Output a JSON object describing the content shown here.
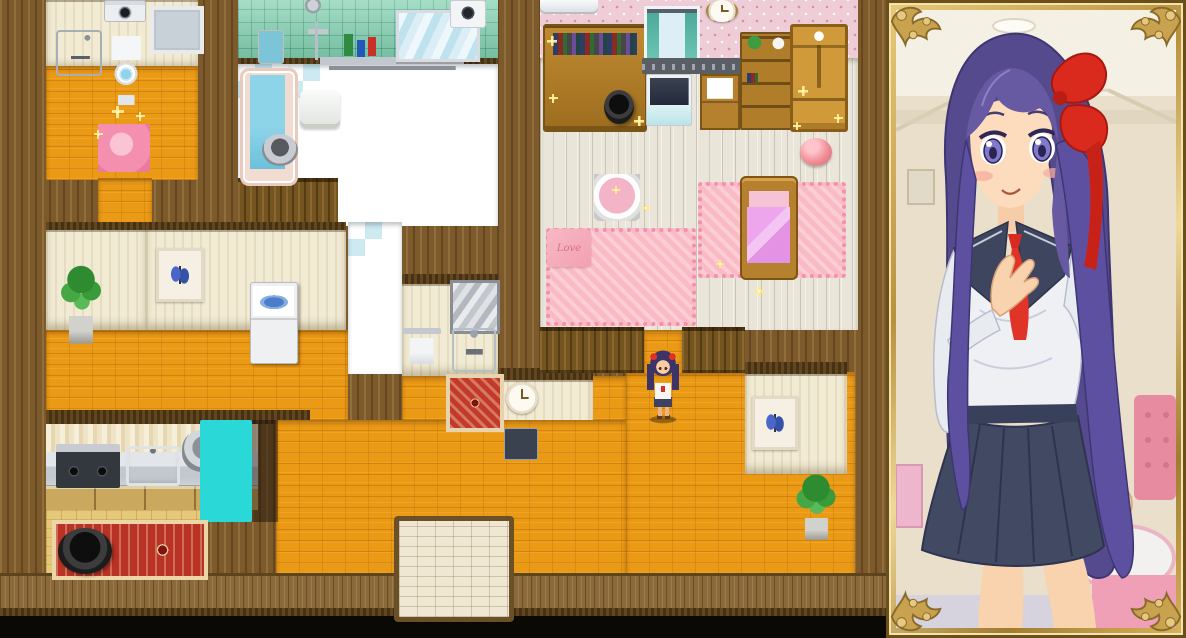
{
  "scene": {
    "view": "top-down-house-map-with-character-portrait",
    "texts": {
      "love_pillow": "Love"
    }
  },
  "palette": {
    "floor_orange": "#eb9a16",
    "wall_wood": "#7c5a2b",
    "wall_cream": "#f2ebd4",
    "tile_green": "#84d0b2",
    "checker_blue": "#cde9f2",
    "wallpaper_pink": "#eecdd6",
    "plank_floor": "#e9e6d9",
    "rug_pink": "#f9bac4",
    "bed_blanket_purple": "#e493e4",
    "kitchen_floor": "#e6c879",
    "rug_red": "#b93325",
    "frame_gold": "#c9a24f",
    "hair_purple": "#564a8e",
    "bow_red": "#da2a1e",
    "uniform_navy": "#3e455e",
    "skin": "#fbd9ba"
  },
  "map": {
    "regions": [
      {
        "id": "outer-wall-backdrop",
        "cls": "r-wall-wood",
        "x": 0,
        "y": 0,
        "w": 890,
        "h": 638,
        "i": false
      },
      {
        "id": "toilet-room-wall",
        "cls": "r-wall-cream",
        "x": 46,
        "y": 0,
        "w": 152,
        "h": 70,
        "i": false
      },
      {
        "id": "toilet-room-floor",
        "cls": "r-floor-orange",
        "x": 46,
        "y": 66,
        "w": 152,
        "h": 114,
        "i": false
      },
      {
        "id": "hall-corridor-north",
        "cls": "r-floor-orange",
        "x": 98,
        "y": 178,
        "w": 54,
        "h": 156,
        "i": false
      },
      {
        "id": "bathroom-tile-wall",
        "cls": "r-wall-tile-green",
        "x": 238,
        "y": 0,
        "w": 260,
        "h": 62,
        "i": false
      },
      {
        "id": "bathroom-wall-cap",
        "cls": "r-cap",
        "x": 238,
        "y": 58,
        "w": 260,
        "h": 8,
        "i": false
      },
      {
        "id": "bathroom-floor",
        "cls": "r-floor-checker",
        "x": 286,
        "y": 64,
        "w": 212,
        "h": 162,
        "i": false
      },
      {
        "id": "bathroom-tub-bay",
        "cls": "r-floor-checker",
        "x": 238,
        "y": 64,
        "w": 52,
        "h": 116,
        "i": false
      },
      {
        "id": "tub-south-wall",
        "cls": "r-wall-wood-v",
        "x": 238,
        "y": 178,
        "w": 100,
        "h": 50,
        "i": false
      },
      {
        "id": "bath-corridor",
        "cls": "r-floor-checker",
        "x": 348,
        "y": 222,
        "w": 54,
        "h": 152,
        "i": false
      },
      {
        "id": "plant-niche-cap",
        "cls": "r-cap",
        "x": 46,
        "y": 222,
        "w": 100,
        "h": 10,
        "i": false
      },
      {
        "id": "plant-niche-wall",
        "cls": "r-wall-cream",
        "x": 46,
        "y": 230,
        "w": 100,
        "h": 100,
        "i": false
      },
      {
        "id": "hall-wall-cap",
        "cls": "r-cap",
        "x": 146,
        "y": 222,
        "w": 200,
        "h": 10,
        "i": false
      },
      {
        "id": "hall-wall",
        "cls": "r-wall-cream",
        "x": 146,
        "y": 230,
        "w": 200,
        "h": 100,
        "i": false
      },
      {
        "id": "hall-floor-west",
        "cls": "r-floor-orange",
        "x": 46,
        "y": 330,
        "w": 302,
        "h": 90,
        "i": false
      },
      {
        "id": "hall-floor-mid",
        "cls": "r-floor-orange",
        "x": 402,
        "y": 376,
        "w": 224,
        "h": 44,
        "i": false
      },
      {
        "id": "washroom-wall-cap",
        "cls": "r-cap",
        "x": 402,
        "y": 274,
        "w": 96,
        "h": 10,
        "i": false
      },
      {
        "id": "washroom-wall",
        "cls": "r-wall-cream",
        "x": 402,
        "y": 284,
        "w": 96,
        "h": 92,
        "i": false
      },
      {
        "id": "clock-wall-cap",
        "cls": "r-cap",
        "x": 498,
        "y": 368,
        "w": 95,
        "h": 12,
        "i": false
      },
      {
        "id": "clock-wall",
        "cls": "r-wall-cream",
        "x": 498,
        "y": 380,
        "w": 95,
        "h": 90,
        "i": false
      },
      {
        "id": "kitchen-wall-cap",
        "cls": "r-cap",
        "x": 46,
        "y": 410,
        "w": 264,
        "h": 14,
        "i": false
      },
      {
        "id": "kitchen-curtain",
        "cls": "r-curtain",
        "x": 46,
        "y": 424,
        "w": 212,
        "h": 32,
        "i": false
      },
      {
        "id": "kitchen-counter",
        "cls": "r-counter",
        "x": 46,
        "y": 452,
        "w": 212,
        "h": 36,
        "i": false
      },
      {
        "id": "kitchen-floor",
        "cls": "r-floor-kitchen",
        "x": 46,
        "y": 486,
        "w": 154,
        "h": 88,
        "i": false
      },
      {
        "id": "floor-south-center",
        "cls": "r-floor-orange",
        "x": 276,
        "y": 420,
        "w": 350,
        "h": 154,
        "i": false
      },
      {
        "id": "floor-south-east",
        "cls": "r-floor-orange",
        "x": 626,
        "y": 372,
        "w": 229,
        "h": 202,
        "i": false
      },
      {
        "id": "bedroom-wallpaper",
        "cls": "r-wall-pink",
        "x": 540,
        "y": 0,
        "w": 318,
        "h": 58,
        "i": false
      },
      {
        "id": "bedroom-floor",
        "cls": "r-floor-plank",
        "x": 540,
        "y": 58,
        "w": 318,
        "h": 272,
        "i": false
      },
      {
        "id": "bedroom-doorway-floor",
        "cls": "r-floor-orange",
        "x": 644,
        "y": 330,
        "w": 38,
        "h": 44,
        "i": true
      },
      {
        "id": "bedroom-south-wall-west",
        "cls": "r-wall-wood-v",
        "x": 540,
        "y": 327,
        "w": 104,
        "h": 46,
        "i": false
      },
      {
        "id": "bedroom-south-wall-east",
        "cls": "r-wall-wood-v",
        "x": 682,
        "y": 327,
        "w": 63,
        "h": 46,
        "i": false
      },
      {
        "id": "se-niche-cap",
        "cls": "r-cap",
        "x": 745,
        "y": 362,
        "w": 102,
        "h": 12,
        "i": false
      },
      {
        "id": "se-niche-wall",
        "cls": "r-wall-cream",
        "x": 745,
        "y": 374,
        "w": 102,
        "h": 100,
        "i": false
      },
      {
        "id": "south-wainscot",
        "cls": "r-wainscot",
        "x": 0,
        "y": 573,
        "w": 890,
        "h": 40,
        "i": false
      },
      {
        "id": "south-wall-trim",
        "cls": "r-cap",
        "x": 0,
        "y": 608,
        "w": 890,
        "h": 10,
        "i": false
      },
      {
        "id": "south-doorway-dark",
        "cls": "r-black",
        "x": 0,
        "y": 616,
        "w": 890,
        "h": 22,
        "i": false
      }
    ],
    "objects": [
      {
        "id": "washing-machine-small",
        "cls": "o-washer-front",
        "x": 104,
        "y": 0,
        "w": 40,
        "h": 20,
        "i": true
      },
      {
        "id": "toilet-window",
        "cls": "o-window",
        "x": 150,
        "y": 6,
        "w": 46,
        "h": 40,
        "i": false
      },
      {
        "id": "toilet-sink",
        "cls": "o-sink-wall",
        "x": 56,
        "y": 30,
        "w": 42,
        "h": 42,
        "i": true
      },
      {
        "id": "toilet",
        "cls": "o-toilet",
        "x": 108,
        "y": 34,
        "w": 36,
        "h": 72,
        "i": true
      },
      {
        "id": "toilet-rug",
        "cls": "o-rug-round-pink",
        "x": 98,
        "y": 124,
        "w": 52,
        "h": 48,
        "i": false
      },
      {
        "id": "shower-head",
        "cls": "o-shower",
        "x": 298,
        "y": 0,
        "w": 44,
        "h": 60,
        "i": true
      },
      {
        "id": "bath-control-panel",
        "cls": "o-panel-remote",
        "x": 258,
        "y": 30,
        "w": 24,
        "h": 32,
        "i": true
      },
      {
        "id": "shampoo-shelf",
        "cls": "o-shelf-bottles",
        "x": 320,
        "y": 30,
        "w": 144,
        "h": 40,
        "i": true
      },
      {
        "id": "bathroom-mirror",
        "cls": "o-mirror-wide",
        "x": 396,
        "y": 10,
        "w": 78,
        "h": 46,
        "i": false
      },
      {
        "id": "ventilation-fan",
        "cls": "o-fan",
        "x": 450,
        "y": 0,
        "w": 34,
        "h": 26,
        "i": false
      },
      {
        "id": "bathtub",
        "cls": "o-tub",
        "x": 240,
        "y": 68,
        "w": 52,
        "h": 112,
        "i": true
      },
      {
        "id": "bath-bucket",
        "cls": "o-bucket",
        "x": 262,
        "y": 134,
        "w": 36,
        "h": 32,
        "i": true
      },
      {
        "id": "bath-stool",
        "cls": "o-stool",
        "x": 300,
        "y": 90,
        "w": 40,
        "h": 38,
        "i": true
      },
      {
        "id": "potted-plant-hall",
        "cls": "o-plant",
        "x": 58,
        "y": 252,
        "w": 46,
        "h": 92,
        "i": true
      },
      {
        "id": "butterfly-picture-hall",
        "cls": "o-pic-butterfly",
        "x": 156,
        "y": 248,
        "w": 42,
        "h": 48,
        "i": false
      },
      {
        "id": "washing-machine-top-load",
        "cls": "o-washer-top",
        "x": 250,
        "y": 282,
        "w": 46,
        "h": 80,
        "i": true
      },
      {
        "id": "washroom-mirror",
        "cls": "o-mirror-grey",
        "x": 450,
        "y": 280,
        "w": 44,
        "h": 48,
        "i": false
      },
      {
        "id": "towel-rack",
        "cls": "o-towel-rack",
        "x": 403,
        "y": 328,
        "w": 38,
        "h": 36,
        "i": true
      },
      {
        "id": "washroom-sink",
        "cls": "o-sink-small",
        "x": 452,
        "y": 328,
        "w": 40,
        "h": 40,
        "i": true
      },
      {
        "id": "washroom-rug",
        "cls": "o-rug-red-sq",
        "x": 446,
        "y": 374,
        "w": 50,
        "h": 50,
        "i": false
      },
      {
        "id": "hall-clock",
        "cls": "o-clock",
        "x": 506,
        "y": 382,
        "w": 32,
        "h": 32,
        "i": false
      },
      {
        "id": "wall-phone",
        "cls": "o-phone",
        "x": 504,
        "y": 428,
        "w": 32,
        "h": 30,
        "i": true
      },
      {
        "id": "kitchen-counter-lower",
        "cls": "o-counter-lower",
        "x": 46,
        "y": 486,
        "w": 212,
        "h": 24,
        "i": false
      },
      {
        "id": "stove",
        "cls": "o-stove",
        "x": 56,
        "y": 444,
        "w": 64,
        "h": 44,
        "i": true
      },
      {
        "id": "kitchen-sink",
        "cls": "o-sink-kitchen",
        "x": 126,
        "y": 446,
        "w": 54,
        "h": 40,
        "i": true
      },
      {
        "id": "cooking-pot",
        "cls": "o-pot-steel",
        "x": 182,
        "y": 430,
        "w": 44,
        "h": 42,
        "i": true
      },
      {
        "id": "refrigerator",
        "cls": "o-fridge",
        "x": 200,
        "y": 420,
        "w": 52,
        "h": 102,
        "i": true
      },
      {
        "id": "fridge-shadow",
        "cls": "o-shadow",
        "x": 252,
        "y": 420,
        "w": 26,
        "h": 102,
        "i": false
      },
      {
        "id": "kitchen-rug",
        "cls": "o-rug-red-long",
        "x": 52,
        "y": 520,
        "w": 148,
        "h": 52,
        "i": false
      },
      {
        "id": "kitchen-pot-black",
        "cls": "o-pot-black",
        "x": 58,
        "y": 528,
        "w": 54,
        "h": 46,
        "i": true
      },
      {
        "id": "entry-mat",
        "cls": "o-door-mat",
        "x": 394,
        "y": 516,
        "w": 110,
        "h": 96,
        "i": false
      },
      {
        "id": "butterfly-picture-se",
        "cls": "o-pic-butterfly",
        "x": 752,
        "y": 396,
        "w": 40,
        "h": 48,
        "i": false
      },
      {
        "id": "potted-plant-se",
        "cls": "o-plant",
        "x": 794,
        "y": 466,
        "w": 44,
        "h": 74,
        "i": true
      },
      {
        "id": "air-conditioner",
        "cls": "o-ac-unit",
        "x": 540,
        "y": 0,
        "w": 58,
        "h": 14,
        "i": false
      },
      {
        "id": "study-desk",
        "cls": "o-desk",
        "x": 543,
        "y": 24,
        "w": 100,
        "h": 104,
        "i": true
      },
      {
        "id": "trash-bin",
        "cls": "o-trash-dark",
        "x": 604,
        "y": 90,
        "w": 30,
        "h": 34,
        "i": true
      },
      {
        "id": "bedroom-window",
        "cls": "o-window-teal",
        "x": 644,
        "y": 6,
        "w": 50,
        "h": 50,
        "i": false
      },
      {
        "id": "bedroom-wall-clock",
        "cls": "o-clock",
        "x": 706,
        "y": 0,
        "w": 32,
        "h": 22,
        "i": false
      },
      {
        "id": "wall-rail-shelf",
        "cls": "o-wall-shelf",
        "x": 642,
        "y": 58,
        "w": 102,
        "h": 16,
        "i": false
      },
      {
        "id": "tv-stand",
        "cls": "o-tv",
        "x": 646,
        "y": 74,
        "w": 46,
        "h": 52,
        "i": true
      },
      {
        "id": "papers-cabinet",
        "cls": "o-cabinet-papers",
        "x": 700,
        "y": 74,
        "w": 36,
        "h": 52,
        "i": true
      },
      {
        "id": "bookshelf",
        "cls": "o-bookshelf",
        "x": 740,
        "y": 32,
        "w": 52,
        "h": 94,
        "i": true
      },
      {
        "id": "wardrobe",
        "cls": "o-wardrobe",
        "x": 790,
        "y": 24,
        "w": 52,
        "h": 102,
        "i": true
      },
      {
        "id": "pink-ball",
        "cls": "o-ball-pink",
        "x": 800,
        "y": 138,
        "w": 32,
        "h": 28,
        "i": true
      },
      {
        "id": "vanity-table",
        "cls": "o-table-round",
        "x": 594,
        "y": 174,
        "w": 46,
        "h": 47,
        "i": true
      },
      {
        "id": "bedroom-rug-west",
        "cls": "o-rug-pink",
        "x": 546,
        "y": 228,
        "w": 142,
        "h": 90,
        "i": false
      },
      {
        "id": "love-pillow",
        "cls": "o-pillow-love",
        "x": 547,
        "y": 229,
        "w": 44,
        "h": 38,
        "i": true,
        "bind": "scene.texts.love_pillow"
      },
      {
        "id": "bedroom-rug-east",
        "cls": "o-rug-pink",
        "x": 698,
        "y": 182,
        "w": 140,
        "h": 88,
        "i": false
      },
      {
        "id": "bed",
        "cls": "o-bed",
        "x": 740,
        "y": 176,
        "w": 54,
        "h": 100,
        "i": true
      },
      {
        "id": "sparkle-1",
        "cls": "o-sparkle",
        "x": 112,
        "y": 106,
        "w": 12,
        "h": 12,
        "i": false
      },
      {
        "id": "sparkle-2",
        "cls": "o-sparkle",
        "x": 136,
        "y": 112,
        "w": 9,
        "h": 9,
        "i": false
      },
      {
        "id": "sparkle-3",
        "cls": "o-sparkle",
        "x": 94,
        "y": 130,
        "w": 9,
        "h": 9,
        "i": false
      },
      {
        "id": "sparkle-4",
        "cls": "o-sparkle",
        "x": 547,
        "y": 36,
        "w": 10,
        "h": 10,
        "i": false
      },
      {
        "id": "sparkle-5",
        "cls": "o-sparkle",
        "x": 549,
        "y": 94,
        "w": 9,
        "h": 9,
        "i": false
      },
      {
        "id": "sparkle-6",
        "cls": "o-sparkle",
        "x": 634,
        "y": 116,
        "w": 10,
        "h": 10,
        "i": false
      },
      {
        "id": "sparkle-7",
        "cls": "o-sparkle",
        "x": 798,
        "y": 86,
        "w": 10,
        "h": 10,
        "i": false
      },
      {
        "id": "sparkle-8",
        "cls": "o-sparkle",
        "x": 834,
        "y": 114,
        "w": 9,
        "h": 9,
        "i": false
      },
      {
        "id": "sparkle-9",
        "cls": "o-sparkle",
        "x": 793,
        "y": 122,
        "w": 8,
        "h": 8,
        "i": false
      },
      {
        "id": "sparkle-10",
        "cls": "o-sparkle",
        "x": 754,
        "y": 286,
        "w": 10,
        "h": 10,
        "i": false
      },
      {
        "id": "sparkle-11",
        "cls": "o-sparkle",
        "x": 716,
        "y": 260,
        "w": 8,
        "h": 8,
        "i": false
      },
      {
        "id": "sparkle-12",
        "cls": "o-sparkle",
        "x": 612,
        "y": 186,
        "w": 8,
        "h": 8,
        "i": false
      },
      {
        "id": "sparkle-13",
        "cls": "o-sparkle",
        "x": 642,
        "y": 204,
        "w": 8,
        "h": 8,
        "i": false
      },
      {
        "id": "player-character",
        "cls": "o-sprite-girl",
        "x": 645,
        "y": 350,
        "w": 36,
        "h": 74,
        "i": true
      }
    ]
  },
  "portrait": {
    "character": "schoolgirl-purple-hair-red-bow-sailor-uniform",
    "frame": "ornate-gold"
  }
}
